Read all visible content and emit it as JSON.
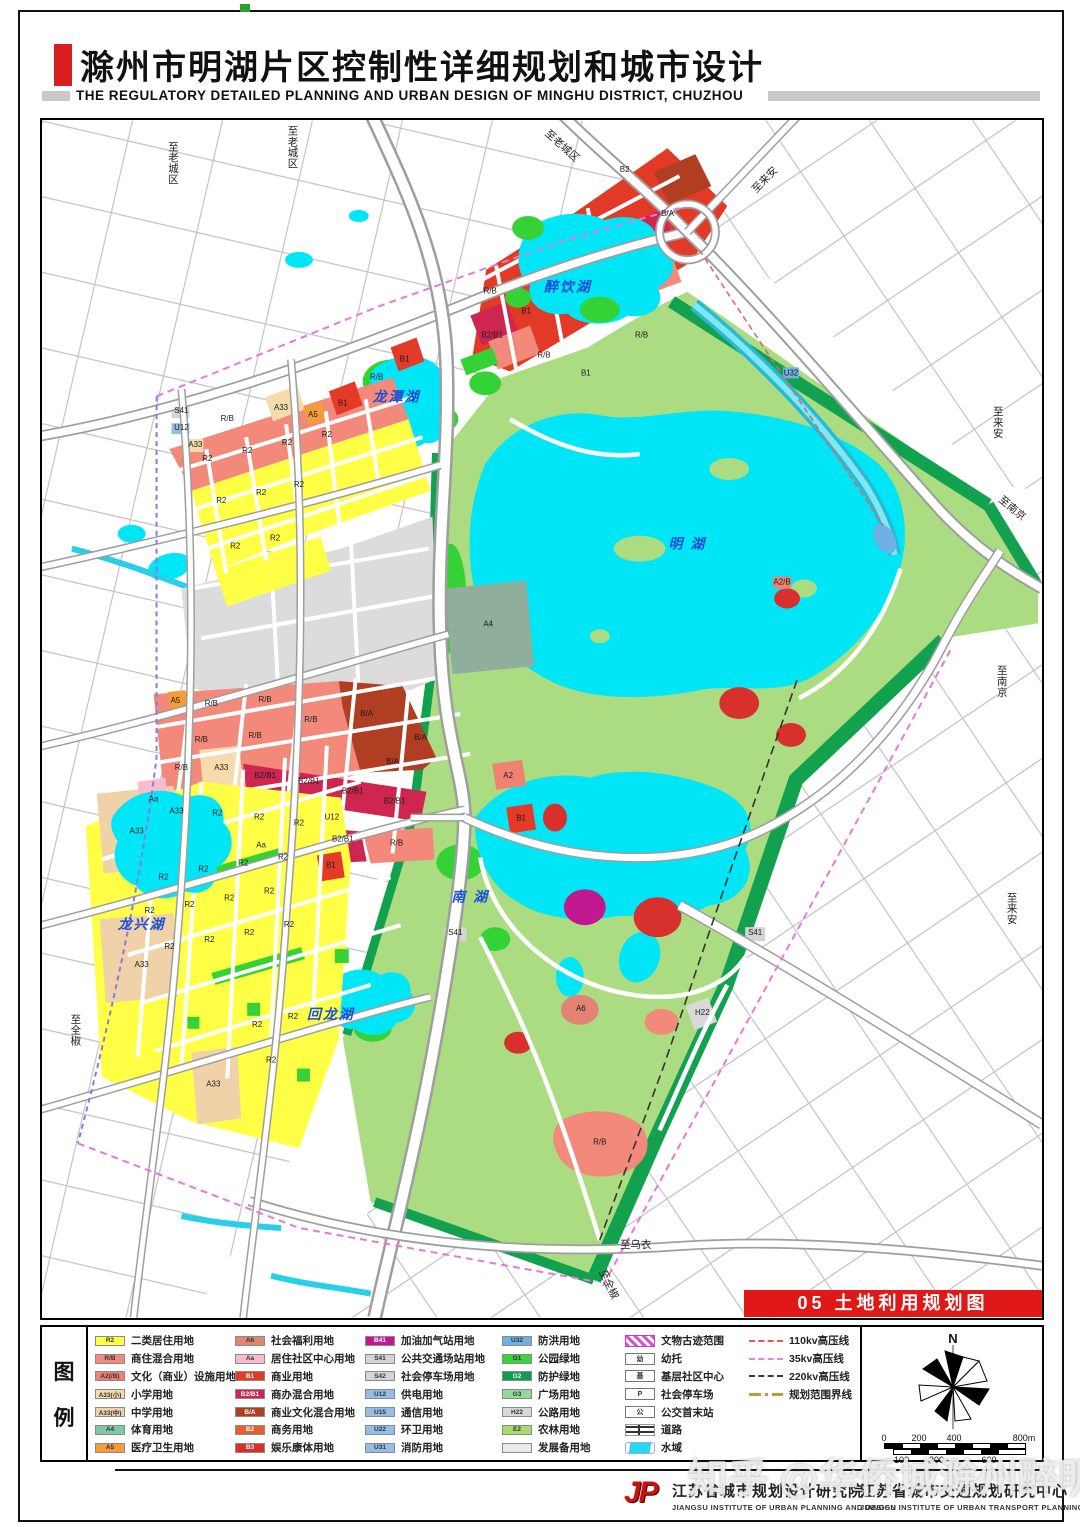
{
  "page": {
    "title": "滁州市明湖片区控制性详细规划和城市设计",
    "subtitle": "THE REGULATORY DETAILED PLANNING AND URBAN DESIGN OF MINGHU DISTRICT, CHUZHOU",
    "banner": "05 土地利用规划图",
    "watermark": "知乎 @华侨城滁州醉明湖"
  },
  "map": {
    "lake_labels": [
      {
        "t": "醉饮湖",
        "x": 528,
        "y": 172
      },
      {
        "t": "龙潭湖",
        "x": 356,
        "y": 282
      },
      {
        "t": "明   湖",
        "x": 648,
        "y": 430
      },
      {
        "t": "南   湖",
        "x": 430,
        "y": 784
      },
      {
        "t": "回龙湖",
        "x": 290,
        "y": 902
      },
      {
        "t": "龙兴湖",
        "x": 100,
        "y": 812
      }
    ],
    "edge_labels": [
      {
        "t": "至老城区",
        "x": 132,
        "y": 30,
        "o": "v"
      },
      {
        "t": "至老城区",
        "x": 252,
        "y": 14,
        "o": "v"
      },
      {
        "t": "至老城区",
        "x": 520,
        "y": 28,
        "o": "r",
        "a": 42
      },
      {
        "t": "至来安",
        "x": 728,
        "y": 62,
        "o": "r",
        "a": -46
      },
      {
        "t": "至来安",
        "x": 960,
        "y": 296,
        "o": "v"
      },
      {
        "t": "至南京",
        "x": 972,
        "y": 392,
        "o": "r",
        "a": 40
      },
      {
        "t": "至南京",
        "x": 964,
        "y": 556,
        "o": "v"
      },
      {
        "t": "至来安",
        "x": 974,
        "y": 784,
        "o": "v"
      },
      {
        "t": "至乌衣",
        "x": 596,
        "y": 1132,
        "o": "h"
      },
      {
        "t": "至全椒",
        "x": 34,
        "y": 906,
        "o": "v"
      },
      {
        "t": "至全椒",
        "x": 566,
        "y": 1170,
        "o": "r",
        "a": 64
      }
    ],
    "parcel_labels": [
      {
        "x": 585,
        "y": 52,
        "t": "B2"
      },
      {
        "x": 628,
        "y": 96,
        "t": "B/A"
      },
      {
        "x": 450,
        "y": 174,
        "t": "R/B"
      },
      {
        "x": 486,
        "y": 194,
        "t": "B1"
      },
      {
        "x": 452,
        "y": 218,
        "t": "B2/B1"
      },
      {
        "x": 504,
        "y": 238,
        "t": "R/B"
      },
      {
        "x": 546,
        "y": 256,
        "t": "B1"
      },
      {
        "x": 602,
        "y": 218,
        "t": "R/B"
      },
      {
        "x": 140,
        "y": 294,
        "t": "S41"
      },
      {
        "x": 140,
        "y": 311,
        "t": "U12"
      },
      {
        "x": 154,
        "y": 328,
        "t": "A33"
      },
      {
        "x": 186,
        "y": 302,
        "t": "R/B"
      },
      {
        "x": 240,
        "y": 291,
        "t": "A33"
      },
      {
        "x": 272,
        "y": 298,
        "t": "A5"
      },
      {
        "x": 302,
        "y": 286,
        "t": "B1"
      },
      {
        "x": 336,
        "y": 260,
        "t": "R/B"
      },
      {
        "x": 364,
        "y": 242,
        "t": "B1"
      },
      {
        "x": 166,
        "y": 342,
        "t": "R2"
      },
      {
        "x": 206,
        "y": 334,
        "t": "R2"
      },
      {
        "x": 246,
        "y": 326,
        "t": "R2"
      },
      {
        "x": 286,
        "y": 318,
        "t": "R2"
      },
      {
        "x": 180,
        "y": 384,
        "t": "R2"
      },
      {
        "x": 220,
        "y": 376,
        "t": "R2"
      },
      {
        "x": 258,
        "y": 368,
        "t": "R2"
      },
      {
        "x": 194,
        "y": 430,
        "t": "R2"
      },
      {
        "x": 234,
        "y": 422,
        "t": "R2"
      },
      {
        "x": 134,
        "y": 585,
        "t": "A5"
      },
      {
        "x": 170,
        "y": 588,
        "t": "R/B"
      },
      {
        "x": 224,
        "y": 584,
        "t": "R/B"
      },
      {
        "x": 270,
        "y": 604,
        "t": "R/B"
      },
      {
        "x": 160,
        "y": 624,
        "t": "R/B"
      },
      {
        "x": 214,
        "y": 620,
        "t": "R/B"
      },
      {
        "x": 326,
        "y": 598,
        "t": "B/A"
      },
      {
        "x": 352,
        "y": 646,
        "t": "B/A"
      },
      {
        "x": 380,
        "y": 622,
        "t": "B/A"
      },
      {
        "x": 140,
        "y": 652,
        "t": "R/B"
      },
      {
        "x": 180,
        "y": 652,
        "t": "A33"
      },
      {
        "x": 224,
        "y": 660,
        "t": "B2/B1"
      },
      {
        "x": 268,
        "y": 666,
        "t": "B2/B1"
      },
      {
        "x": 312,
        "y": 676,
        "t": "B2/B1"
      },
      {
        "x": 354,
        "y": 686,
        "t": "B2/B1"
      },
      {
        "x": 302,
        "y": 724,
        "t": "B2/B1"
      },
      {
        "x": 356,
        "y": 728,
        "t": "R/B"
      },
      {
        "x": 135,
        "y": 696,
        "t": "A33"
      },
      {
        "x": 176,
        "y": 698,
        "t": "R2"
      },
      {
        "x": 218,
        "y": 702,
        "t": "R2"
      },
      {
        "x": 258,
        "y": 708,
        "t": "R2"
      },
      {
        "x": 220,
        "y": 730,
        "t": "Aa"
      },
      {
        "x": 291,
        "y": 702,
        "t": "U12"
      },
      {
        "x": 95,
        "y": 716,
        "t": "A33"
      },
      {
        "x": 112,
        "y": 684,
        "t": "Aa"
      },
      {
        "x": 100,
        "y": 850,
        "t": "A33"
      },
      {
        "x": 172,
        "y": 970,
        "t": "A33"
      },
      {
        "x": 290,
        "y": 750,
        "t": "B1"
      },
      {
        "x": 122,
        "y": 762,
        "t": "R2"
      },
      {
        "x": 162,
        "y": 754,
        "t": "R2"
      },
      {
        "x": 202,
        "y": 748,
        "t": "R2"
      },
      {
        "x": 242,
        "y": 742,
        "t": "R2"
      },
      {
        "x": 108,
        "y": 796,
        "t": "R2"
      },
      {
        "x": 148,
        "y": 790,
        "t": "R2"
      },
      {
        "x": 188,
        "y": 783,
        "t": "R2"
      },
      {
        "x": 228,
        "y": 776,
        "t": "R2"
      },
      {
        "x": 128,
        "y": 832,
        "t": "R2"
      },
      {
        "x": 168,
        "y": 825,
        "t": "R2"
      },
      {
        "x": 208,
        "y": 818,
        "t": "R2"
      },
      {
        "x": 248,
        "y": 810,
        "t": "R2"
      },
      {
        "x": 216,
        "y": 910,
        "t": "R2"
      },
      {
        "x": 252,
        "y": 902,
        "t": "R2"
      },
      {
        "x": 230,
        "y": 946,
        "t": "R2"
      },
      {
        "x": 448,
        "y": 508,
        "t": "A4"
      },
      {
        "x": 468,
        "y": 660,
        "t": "A2"
      },
      {
        "x": 481,
        "y": 703,
        "t": "B1"
      },
      {
        "x": 415,
        "y": 818,
        "t": "S41"
      },
      {
        "x": 716,
        "y": 818,
        "t": "S41"
      },
      {
        "x": 663,
        "y": 898,
        "t": "H22"
      },
      {
        "x": 541,
        "y": 894,
        "t": "A6"
      },
      {
        "x": 560,
        "y": 1028,
        "t": "R/B"
      },
      {
        "x": 743,
        "y": 466,
        "t": "A2/B"
      },
      {
        "x": 752,
        "y": 256,
        "t": "U32"
      }
    ]
  },
  "legend": {
    "panel_title": [
      "图",
      "例"
    ],
    "landuse_columns": [
      [
        {
          "code": "R2",
          "color": "#FFFF45",
          "label": "二类居住用地"
        },
        {
          "code": "R/B",
          "color": "#F2897B",
          "label": "商住混合用地"
        },
        {
          "code": "A2(/B)",
          "color": "#EF8272",
          "label": "文化（商业）设施用地"
        },
        {
          "code": "A33(小)",
          "color": "#F6DCAC",
          "label": "小学用地"
        },
        {
          "code": "A33(中)",
          "color": "#EFD2A8",
          "label": "中学用地"
        },
        {
          "code": "A4",
          "color": "#7EC9A3",
          "label": "体育用地"
        },
        {
          "code": "A5",
          "color": "#F59B3B",
          "label": "医疗卫生用地"
        }
      ],
      [
        {
          "code": "A6",
          "color": "#E28373",
          "label": "社会福利用地"
        },
        {
          "code": "Aa",
          "color": "#F7BCD0",
          "label": "居住社区中心用地"
        },
        {
          "code": "B1",
          "color": "#E43A28",
          "label": "商业用地",
          "dark": true
        },
        {
          "code": "B2/B1",
          "color": "#CE2651",
          "label": "商办混合用地",
          "dark": true
        },
        {
          "code": "B/A",
          "color": "#AF3E23",
          "label": "商业文化混合用地",
          "dark": true
        },
        {
          "code": "B2",
          "color": "#E4602F",
          "label": "商务用地",
          "dark": true
        },
        {
          "code": "B3",
          "color": "#D8302C",
          "label": "娱乐康体用地",
          "dark": true
        }
      ],
      [
        {
          "code": "B41",
          "color": "#C2188F",
          "label": "加油加气站用地",
          "dark": true
        },
        {
          "code": "S41",
          "color": "#D4D4D4",
          "label": "公共交通场站用地"
        },
        {
          "code": "S42",
          "color": "#D4D4D4",
          "label": "社会停车场用地"
        },
        {
          "code": "U12",
          "color": "#92BEE8",
          "label": "供电用地"
        },
        {
          "code": "U15",
          "color": "#92BEE8",
          "label": "通信用地"
        },
        {
          "code": "U22",
          "color": "#92BEE8",
          "label": "环卫用地"
        },
        {
          "code": "U31",
          "color": "#92BEE8",
          "label": "消防用地"
        }
      ],
      [
        {
          "code": "U32",
          "color": "#6FB1E4",
          "label": "防洪用地"
        },
        {
          "code": "G1",
          "color": "#3BD53B",
          "label": "公园绿地"
        },
        {
          "code": "G2",
          "color": "#129B51",
          "label": "防护绿地",
          "dark": true
        },
        {
          "code": "G3",
          "color": "#93D99A",
          "label": "广场用地"
        },
        {
          "code": "H22",
          "color": "#D9D9D9",
          "label": "公路用地"
        },
        {
          "code": "E2",
          "color": "#A9DA6E",
          "label": "农林用地"
        },
        {
          "code": "",
          "color": "#EBEBEB",
          "label": "发展备用地"
        }
      ]
    ],
    "symbols": [
      {
        "icon": "heritage",
        "label": "文物古迹范围"
      },
      {
        "icon": "box",
        "glyph": "幼",
        "label": "幼托"
      },
      {
        "icon": "box",
        "glyph": "基",
        "label": "基层社区中心"
      },
      {
        "icon": "box",
        "glyph": "P",
        "label": "社会停车场"
      },
      {
        "icon": "box",
        "glyph": "公",
        "label": "公交首末站"
      },
      {
        "icon": "road",
        "label": "道路"
      },
      {
        "icon": "water",
        "label": "水域"
      }
    ],
    "lines": [
      {
        "style": "dash-red",
        "label": "110kv高压线"
      },
      {
        "style": "dash-pink",
        "label": "35kv高压线"
      },
      {
        "style": "dash-black",
        "label": "220kv高压线"
      },
      {
        "style": "dashdot-orange",
        "label": "规划范围界线"
      }
    ],
    "north_label": "N",
    "scale_top": [
      "0",
      "200",
      "400",
      "800m"
    ],
    "scale_bottom": [
      "100",
      "300",
      "600"
    ]
  },
  "footer": {
    "logo_text": "JP",
    "institutes": [
      {
        "cn": "江苏省城市规划设计研究院",
        "en": "JIANGSU INSTITUTE OF URBAN PLANNING AND DESIGN"
      },
      {
        "cn": "江苏省城市交通规划研究中心",
        "en": "JIANGSU INSTITUTE OF URBAN TRANSPORT PLANNING"
      }
    ]
  }
}
